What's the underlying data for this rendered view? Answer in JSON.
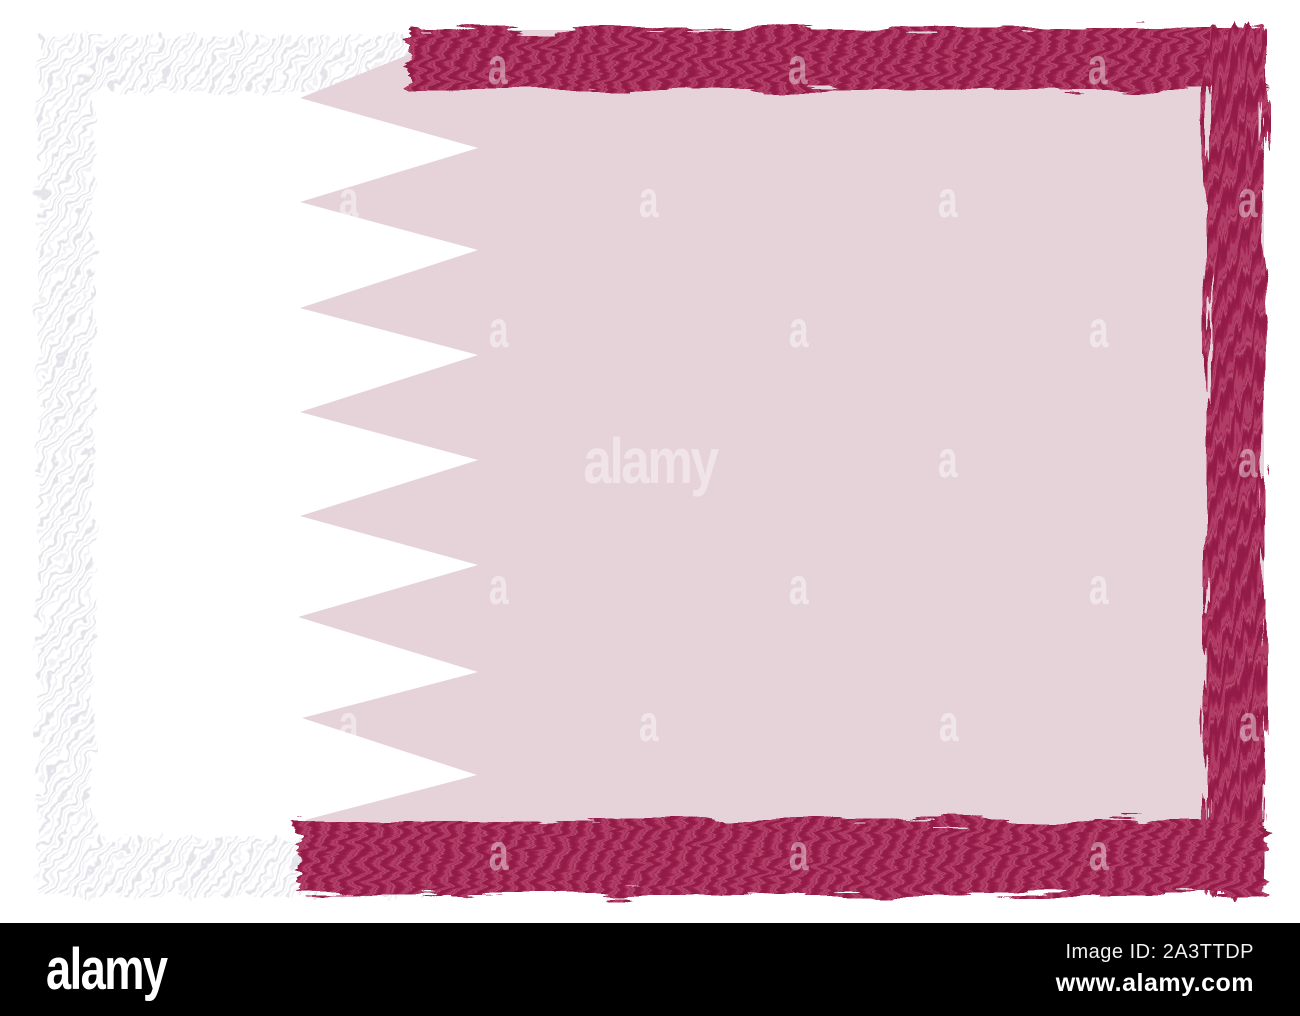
{
  "image": {
    "subject": "Qatar flag brush border",
    "colors": {
      "background": "#ffffff",
      "flag_white": "#ffffff",
      "flag_field_pink": "#e6d3da",
      "maroon": "#9f2350",
      "maroon_dark": "#861a40",
      "maroon_light": "#c15679",
      "maroon_highlight": "#d98ba4",
      "frame_hatch_gray": "#e4e4ea",
      "frame_hatch_light": "#f2f2f5"
    }
  },
  "watermark": {
    "glyph": "a",
    "center_text": "alamy",
    "color": "#ffffff"
  },
  "footer": {
    "background": "#000000",
    "logo_text": "alamy",
    "image_id_text": "Image ID: 2A3TTDP",
    "website_text": "www.alamy.com",
    "text_color": "#ffffff"
  }
}
